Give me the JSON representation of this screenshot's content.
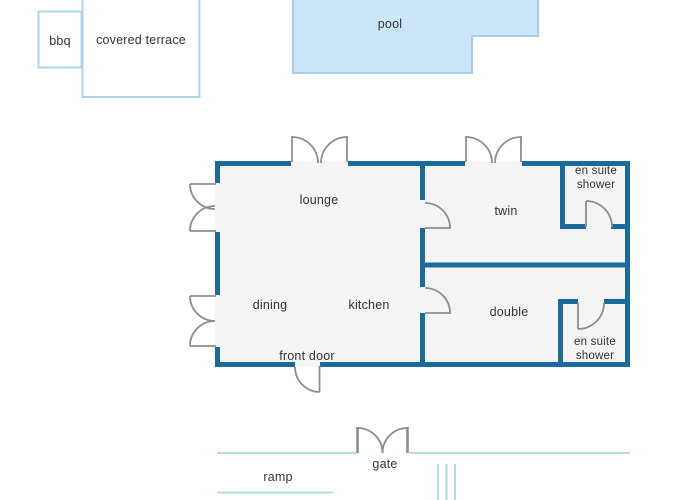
{
  "colors": {
    "wall": "#1a6a9b",
    "door": "#8e8e8e",
    "fence": "#aedde6",
    "poolFill": "#cce6f8",
    "poolStroke": "#a5cfe9",
    "lightBorder": "#aad4ea",
    "interior": "#f4f4f5",
    "text": "#333333"
  },
  "outdoor": {
    "bbq": "bbq",
    "covered_terrace": "covered terrace",
    "pool": "pool",
    "ramp": "ramp",
    "gate": "gate"
  },
  "rooms": {
    "lounge": "lounge",
    "dining": "dining",
    "kitchen": "kitchen",
    "twin": "twin",
    "double": "double",
    "ensuite_top": "en suite shower",
    "ensuite_bottom": "en suite shower",
    "front_door": "front door"
  }
}
